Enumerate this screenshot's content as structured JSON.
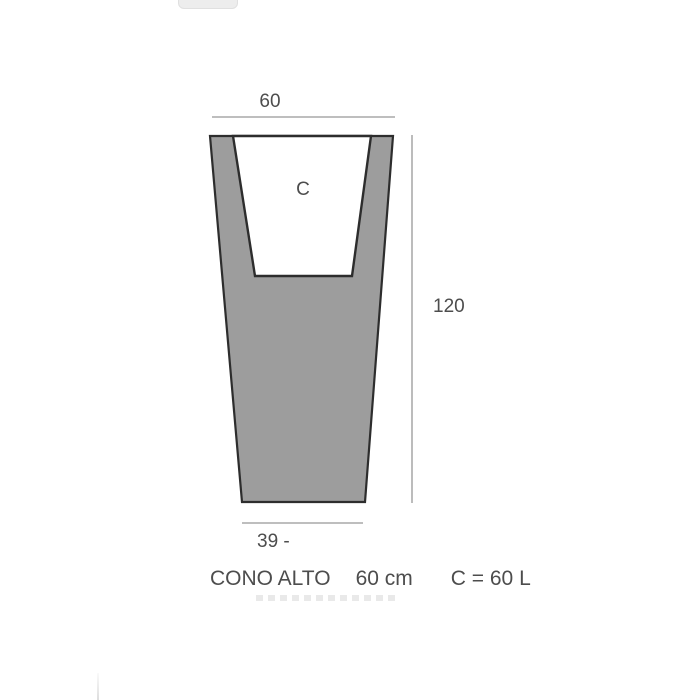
{
  "colors": {
    "pot_fill": "#9d9d9d",
    "outline": "#2d2d2d",
    "dim_line": "#b5b5b5",
    "text": "#4d4d4d",
    "fragment": "#ededed",
    "fragment_border": "#e0e0e0",
    "ghost": "#e2e2e2"
  },
  "diagram": {
    "top_width_label": "60",
    "height_label": "120",
    "bottom_width_label": "39 -",
    "cavity_label": "C"
  },
  "caption": {
    "product_name": "CONO ALTO",
    "size": "60 cm",
    "capacity": "C = 60 L"
  }
}
